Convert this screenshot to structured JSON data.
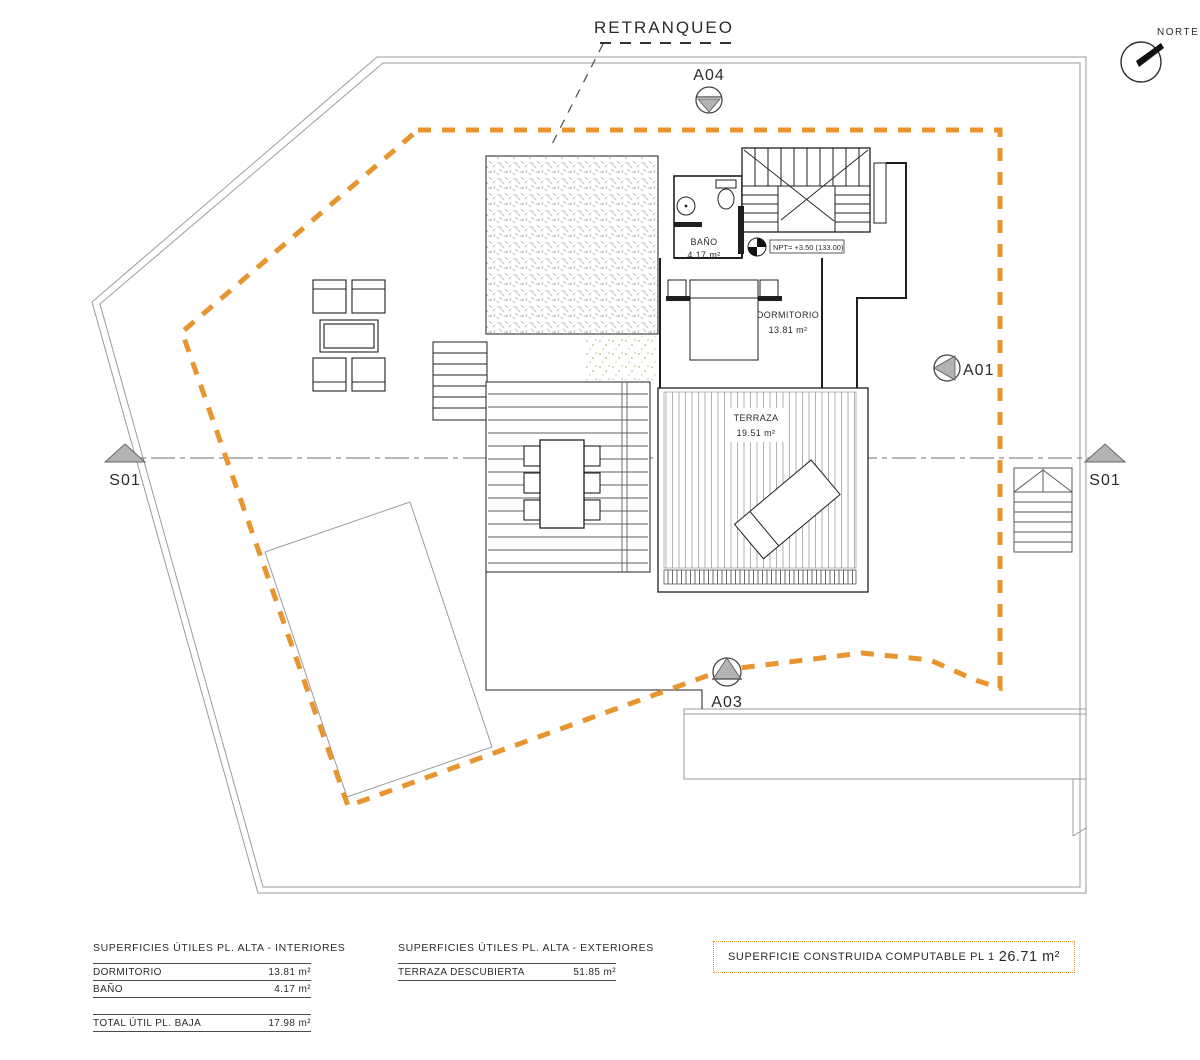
{
  "labels": {
    "retranqueo": "RETRANQUEO",
    "norte": "NORTE",
    "level_mark": "NPT= +3.50 (133.00)"
  },
  "markers": {
    "a04": "A04",
    "a01": "A01",
    "a03": "A03",
    "s01_left": "S01",
    "s01_right": "S01"
  },
  "rooms": [
    {
      "name": "BAÑO",
      "area": "4.17 m²"
    },
    {
      "name": "DORMITORIO",
      "area": "13.81 m²"
    },
    {
      "name": "TERRAZA",
      "area": "19.51 m²"
    }
  ],
  "tables": {
    "interiores": {
      "title": "SUPERFICIES ÚTILES PL. ALTA - INTERIORES",
      "rows": [
        {
          "label": "DORMITORIO",
          "value": "13.81 m²"
        },
        {
          "label": "BAÑO",
          "value": "4.17 m²"
        }
      ],
      "total": {
        "label": "TOTAL ÚTIL PL. BAJA",
        "value": "17.98 m²"
      }
    },
    "exteriores": {
      "title": "SUPERFICIES ÚTILES PL. ALTA - EXTERIORES",
      "rows": [
        {
          "label": "TERRAZA DESCUBIERTA",
          "value": "51.85 m²"
        }
      ]
    },
    "computable": {
      "label": "SUPERFICIE CONSTRUIDA COMPUTABLE PL 1",
      "value": "26.71 m²"
    }
  },
  "colors": {
    "setback_orange": "#E8952F",
    "wall_black": "#1f1f1f",
    "plot_gray": "#9b9b9b",
    "triangle_gray": "#b3b3b3"
  }
}
